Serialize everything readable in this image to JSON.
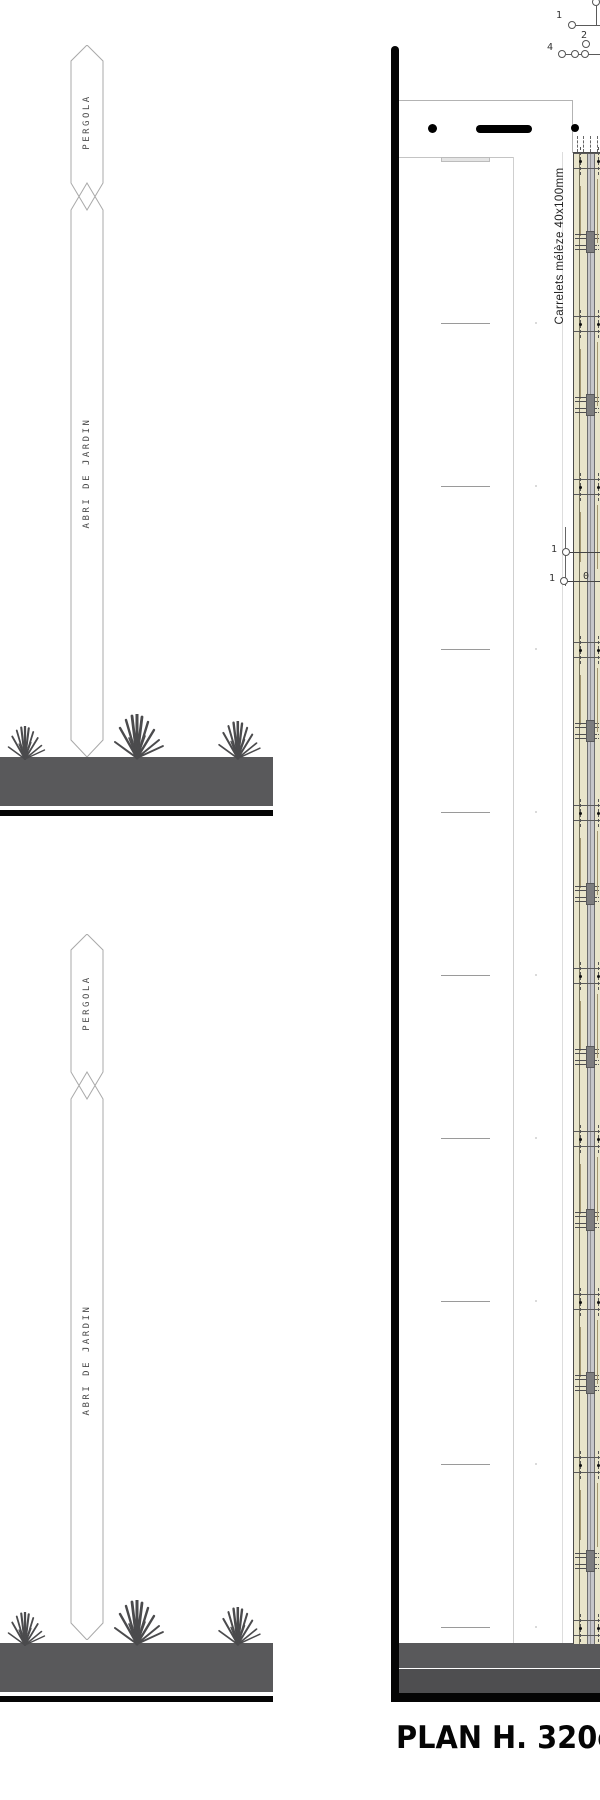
{
  "sections": [
    {
      "top_label": "PERGOLA",
      "bottom_label": "ABRI DE JARDIN"
    },
    {
      "top_label": "PERGOLA",
      "bottom_label": "ABRI DE JARDIN"
    }
  ],
  "plan": {
    "material_note": "Carrelets mélèze 40x100mm",
    "title": "PLAN H. 320cm _ P",
    "callouts_top": {
      "c1": "1",
      "c2": "2",
      "c4": "4"
    },
    "callouts_mid": {
      "r1": "1",
      "r2": "1",
      "r2b": "0"
    }
  },
  "colors": {
    "ground": "#59595b",
    "ground_dark": "#4e4e50",
    "wood": "#e9e5cb",
    "detail_gray": "#7d7d7f",
    "line_black": "#050505"
  }
}
